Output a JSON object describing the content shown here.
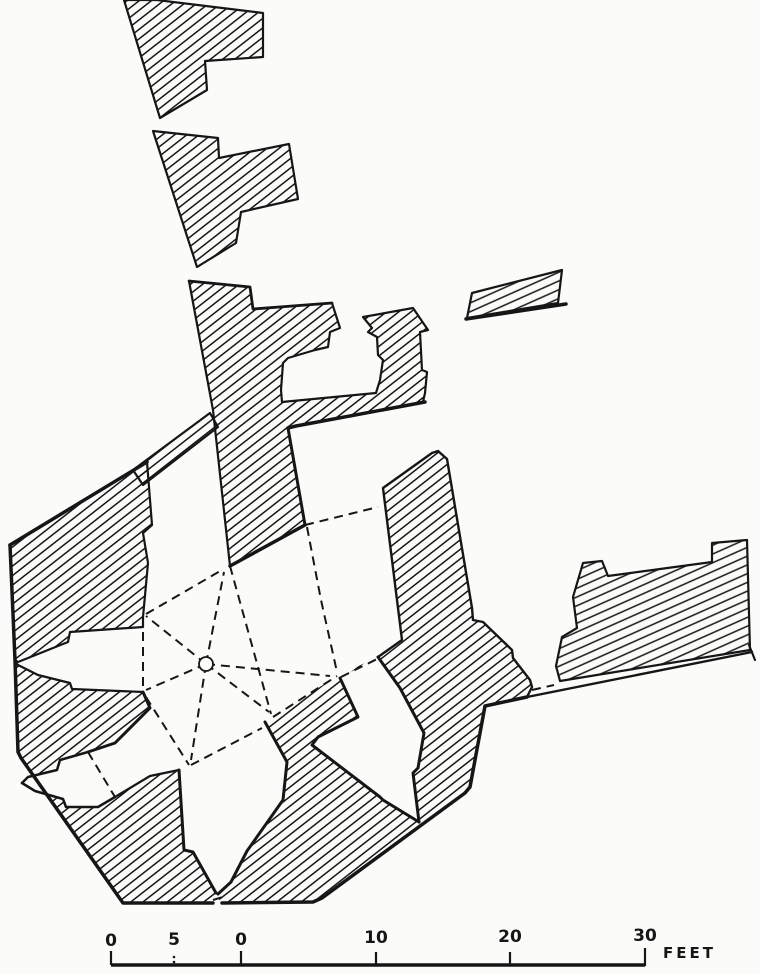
{
  "figure": {
    "kind": "excavation-ground-plan",
    "background": "#fbfbf9",
    "ink": "#161616",
    "viewbox": "0 0 760 974"
  },
  "plan": {
    "hatch": {
      "main": {
        "angle": -38,
        "spacing": 7.5,
        "stroke_width": 1.5
      },
      "east": {
        "angle": -24,
        "spacing": 8,
        "stroke_width": 1.5
      }
    },
    "underlay_lines": [
      {
        "name": "boundary-line-east",
        "points": "497,703 752,652",
        "width": 2.4
      },
      {
        "name": "boundary-line-east-end-tick",
        "points": "749,645 755,660",
        "width": 2.2
      }
    ],
    "walls": [
      {
        "name": "wall-northwest-upper",
        "hatch": "main",
        "stroke": "full",
        "points": "124,0 157,0 263,13 263,57 205,61 207,90 160,118"
      },
      {
        "name": "wall-northwest-middle",
        "hatch": "main",
        "stroke": "full",
        "points": "153,131 218,138 219,158 289,144 298,199 241,212 236,243 197,267"
      },
      {
        "name": "wall-north-mass",
        "hatch": "main",
        "stroke": "full",
        "points": "189,281 250,287 253,309 332,303 340,328 330,332 328,347 315,350 288,358 283,363 281,390 282,402 376,393 380,380 383,360 378,355 377,337 368,332 372,328 363,317 413,308 428,330 420,332 422,370 427,372 425,393 423,402 296,426 288,428 305,525 230,566 213,410"
      },
      {
        "name": "wall-band-fragment",
        "hatch": "main",
        "stroke": "full",
        "points": "133,470 210,413 218,427 143,485"
      },
      {
        "name": "wall-west-mass",
        "hatch": "main",
        "stroke": "full",
        "points": "147,462 10,545 15,660 18,662 68,642 70,632 143,627 143,617 148,563 143,533 152,525"
      },
      {
        "name": "wall-southwest-mass",
        "hatch": "main",
        "stroke": "none",
        "points": "15,662 18,665 38,675 70,683 72,689 143,692 150,708 115,743 88,752 115,797 150,776 179,770 184,850 193,852 216,893 213,903 123,903 21,758 18,752"
      },
      {
        "name": "wall-southeast-mass",
        "hatch": "main",
        "stroke": "none",
        "points": "322,898 313,902 220,903 218,894 231,882 247,851 283,800 287,762 265,722 273,717 337,676 378,657 402,640 383,488 432,453 438,451 447,459 472,608 473,620 483,622 512,650 513,658 530,680 532,687 527,697 485,706 470,787 465,793"
      },
      {
        "name": "wall-east-mass",
        "hatch": "east",
        "stroke": "full",
        "points": "573,597 583,563 602,561 608,576 712,562 712,543 747,540 750,650 560,681 556,666 562,637 577,628"
      },
      {
        "name": "wall-detached-block",
        "hatch": "east",
        "stroke": "full",
        "points": "467,318 472,293 562,270 558,303"
      }
    ],
    "white_recesses": [
      {
        "name": "recess-southwest-niche",
        "points": "88,752 60,760 57,770 28,777 22,783 35,791 63,799 66,807 98,807 115,797"
      },
      {
        "name": "recess-southeast-niche",
        "points": "340,678 358,717 318,737 312,745 380,797 383,800 419,822 413,773 418,768 424,733 400,688 378,657"
      }
    ],
    "edges": [
      {
        "name": "edge-west-mass-top",
        "points": "147,462 10,545",
        "width": 3.5
      },
      {
        "name": "edge-outer-southwest",
        "points": "10,545 15,660 18,752 21,758 123,903 213,903",
        "width": 3.5
      },
      {
        "name": "edge-room-north-face",
        "points": "230,566 305,525",
        "width": 3.5
      },
      {
        "name": "edge-strip-bottom",
        "points": "425,402 296,426 288,428",
        "width": 3.5
      },
      {
        "name": "edge-room-east-face",
        "points": "288,428 305,525",
        "width": 3
      },
      {
        "name": "edge-north-mass-top",
        "points": "189,281 250,287 253,309 332,303",
        "width": 2.8
      },
      {
        "name": "edge-detached-block-base",
        "points": "466,319 566,304",
        "width": 3.5
      },
      {
        "name": "edge-southeast-outer",
        "points": "527,697 485,706 470,787 465,793 322,898 313,902 222,903",
        "width": 3.5
      },
      {
        "name": "edge-southeast-west-side",
        "points": "378,657 402,640 383,488 432,453 438,451 447,459 472,608 473,620 483,622 512,650 513,658 530,680 532,687 527,697",
        "width": 2.4
      },
      {
        "name": "edge-south-arrow-left",
        "points": "179,770 184,850 193,852 216,893",
        "width": 3
      },
      {
        "name": "edge-south-arrow-right",
        "points": "218,894 231,882 247,851 283,800 287,762 265,722",
        "width": 3
      },
      {
        "name": "edge-se-niche-left",
        "points": "340,678 358,717 318,737 312,745 380,797 383,800 419,822",
        "width": 3
      },
      {
        "name": "edge-se-niche-right",
        "points": "419,822 413,773 418,768 424,733 400,688 378,657",
        "width": 3
      },
      {
        "name": "edge-sw-mass-inner-a",
        "points": "15,662 18,665 38,675 70,683 72,689 143,692",
        "width": 2.2
      },
      {
        "name": "edge-sw-mass-inner-b",
        "points": "143,692 150,708 115,743 88,752",
        "width": 3
      },
      {
        "name": "edge-sw-mass-inner-c",
        "points": "115,797 150,776 179,770",
        "width": 2.2
      },
      {
        "name": "edge-sw-niche-top",
        "points": "88,752 60,760 57,770 28,777 22,783",
        "width": 2.5
      },
      {
        "name": "edge-sw-niche-bottom",
        "points": "22,783 35,791 63,799 66,807 98,807 115,797",
        "width": 2.5
      }
    ],
    "dashed_lines": [
      {
        "name": "rib-west-niche-chord",
        "points": "143,617 143,692"
      },
      {
        "name": "rib-niche-to-room-corner",
        "points": "146,614 222,570"
      },
      {
        "name": "rib-pier-to-nw",
        "points": "206,664 146,616"
      },
      {
        "name": "rib-pier-to-w",
        "points": "206,664 146,690"
      },
      {
        "name": "rib-pier-to-n",
        "points": "206,664 224,572"
      },
      {
        "name": "rib-pier-to-se",
        "points": "206,664 269,712"
      },
      {
        "name": "rib-pier-to-e",
        "points": "206,664 330,676"
      },
      {
        "name": "rib-pier-to-s",
        "points": "206,664 191,760"
      },
      {
        "name": "rib-room-northeast",
        "points": "230,566 271,714"
      },
      {
        "name": "rib-se-spur",
        "points": "273,717 337,676"
      },
      {
        "name": "rib-room-to-east-mass",
        "points": "305,525 378,507"
      },
      {
        "name": "rib-room-east-side",
        "points": "307,527 321,600 337,672"
      },
      {
        "name": "rib-se-niche-mouth",
        "points": "341,677 379,658"
      },
      {
        "name": "rib-east-gap",
        "points": "532,690 554,685"
      },
      {
        "name": "rib-junction-from-w",
        "points": "146,697 189,765"
      },
      {
        "name": "rib-junction-to-se",
        "points": "191,765 262,728"
      },
      {
        "name": "rib-sw-niche-chord",
        "points": "88,752 115,797"
      },
      {
        "name": "rib-south-gap",
        "points": "213,900 226,896"
      }
    ],
    "pier": {
      "name": "central-pier-circle",
      "cx": 206,
      "cy": 664,
      "r": 7
    }
  },
  "scale_bar": {
    "unit_label": "FEET",
    "bar": {
      "x1": 111,
      "x2": 645,
      "y": 965,
      "width": 3.5
    },
    "ticks": [
      {
        "x": 111,
        "y1": 951,
        "y2": 965
      },
      {
        "x": 241,
        "y1": 951,
        "y2": 965
      },
      {
        "x": 376,
        "y1": 952,
        "y2": 964
      },
      {
        "x": 510,
        "y1": 952,
        "y2": 964
      },
      {
        "x": 645,
        "y1": 948,
        "y2": 966
      }
    ],
    "dotted_ticks": [
      {
        "x": 174,
        "y": 957
      },
      {
        "x": 174,
        "y": 962
      }
    ],
    "labels": [
      {
        "text": "0",
        "x": 111,
        "y": 946
      },
      {
        "text": "5",
        "x": 174,
        "y": 945
      },
      {
        "text": "0",
        "x": 241,
        "y": 945
      },
      {
        "text": "10",
        "x": 376,
        "y": 943
      },
      {
        "text": "20",
        "x": 510,
        "y": 942
      },
      {
        "text": "30",
        "x": 645,
        "y": 941
      }
    ],
    "unit_pos": {
      "x": 663,
      "y": 958
    }
  }
}
